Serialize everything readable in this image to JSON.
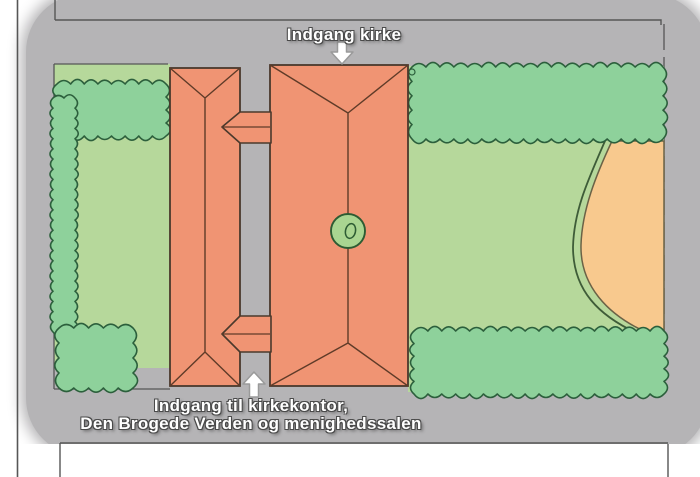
{
  "labels": {
    "top_entrance": "Indgang kirke",
    "bottom_entrance_line1": "Indgang til kirkekontor,",
    "bottom_entrance_line2": "Den Brogede Verden og menighedssalen"
  },
  "icons": {
    "top_arrow": "down-arrow",
    "bottom_arrow": "up-arrow"
  },
  "colors": {
    "page": "#ffffff",
    "gray_background": "#b5b4b6",
    "building_fill": "#f09473",
    "building_outline": "#4a392c",
    "roof_line": "#5f3b28",
    "lawn": "#b6d89b",
    "hedge": "#8ed19b",
    "hedge_outline": "#2c5f3c",
    "sand": "#f8c98e",
    "sand_outline": "#6b6246",
    "path_curve": "#3e5c38",
    "circle_fill": "#a9d591",
    "circle_outline": "#2d5c33",
    "line": "#565656",
    "arrow_fill": "#ffffff",
    "arrow_outline": "#9a9a9a",
    "text": "#ffffff",
    "text_outline": "#4a4a4a"
  }
}
